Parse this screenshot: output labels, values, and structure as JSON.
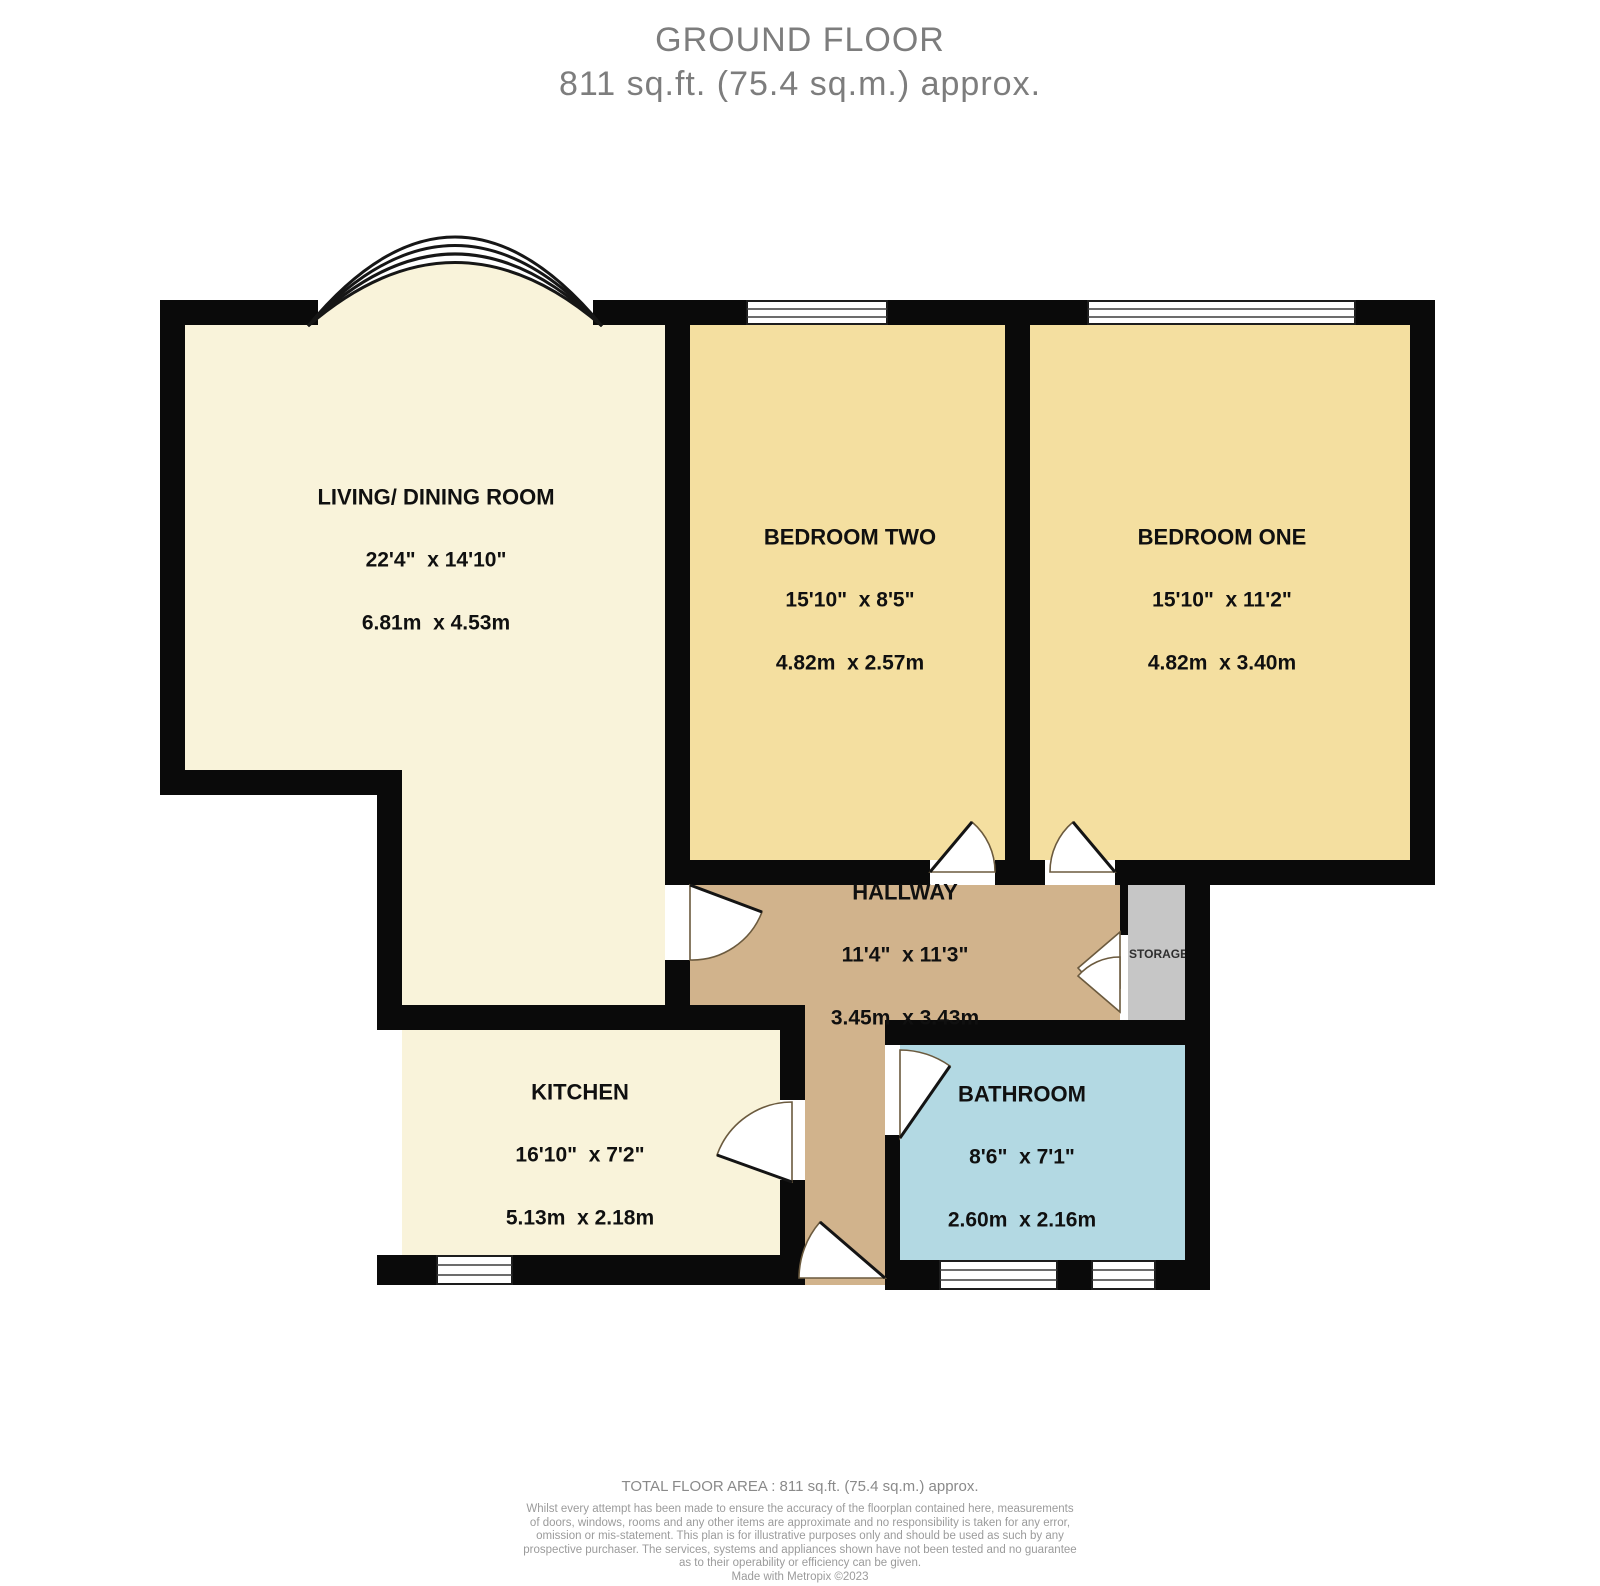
{
  "title": {
    "line1": "GROUND FLOOR",
    "line2": "811 sq.ft. (75.4 sq.m.) approx."
  },
  "rooms": {
    "living": {
      "name": "LIVING/ DINING ROOM",
      "imperial": "22'4\"  x 14'10\"",
      "metric": "6.81m  x 4.53m"
    },
    "bedroom_two": {
      "name": "BEDROOM TWO",
      "imperial": "15'10\"  x 8'5\"",
      "metric": "4.82m  x 2.57m"
    },
    "bedroom_one": {
      "name": "BEDROOM ONE",
      "imperial": "15'10\"  x 11'2\"",
      "metric": "4.82m  x 3.40m"
    },
    "hallway": {
      "name": "HALLWAY",
      "imperial": "11'4\"  x 11'3\"",
      "metric": "3.45m  x 3.43m"
    },
    "kitchen": {
      "name": "KITCHEN",
      "imperial": "16'10\"  x 7'2\"",
      "metric": "5.13m  x 2.18m"
    },
    "bathroom": {
      "name": "BATHROOM",
      "imperial": "8'6\"  x 7'1\"",
      "metric": "2.60m  x 2.16m"
    },
    "storage": {
      "name": "STORAGE"
    }
  },
  "footer": {
    "total": "TOTAL FLOOR AREA : 811 sq.ft. (75.4 sq.m.) approx.",
    "disclaimer_lines": [
      "Whilst every attempt has been made to ensure the accuracy of the floorplan contained here, measurements",
      "of doors, windows, rooms and any other items are approximate and no responsibility is taken for any error,",
      "omission or mis-statement. This plan is for illustrative purposes only and should be used as such by any",
      "prospective purchaser. The services, systems and appliances shown have not been tested and no guarantee",
      "as to their operability or efficiency can be given.",
      "Made with Metropix ©2023"
    ]
  },
  "colors": {
    "wall": "#0a0a0a",
    "cream": "#f9f3da",
    "bedroom": "#f4dfa0",
    "hallway": "#d1b38c",
    "bathroom": "#b3d9e3",
    "storage": "#c6c6c6",
    "title_text": "#7d7d7d",
    "footer_text": "#8a8a8a",
    "disclaimer_text": "#9b9b9b"
  }
}
